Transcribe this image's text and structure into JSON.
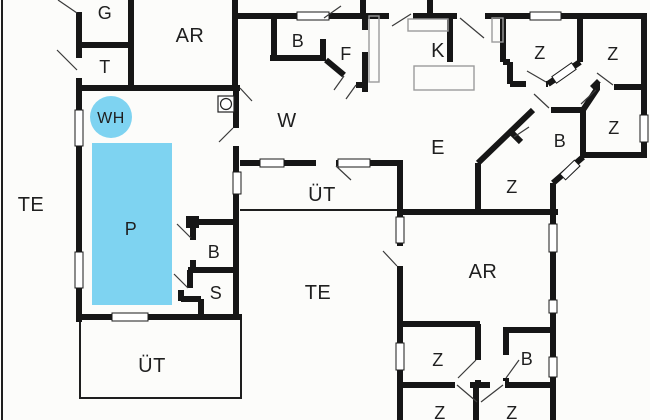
{
  "colors": {
    "pool_blue": "#7ed3f1",
    "wall": "#161616",
    "furniture_gray": "#9b9b9b",
    "background": "#fcfcfa",
    "label": "#1f1f1f"
  },
  "rooms": [
    {
      "id": "g",
      "label": "G"
    },
    {
      "id": "t",
      "label": "T"
    },
    {
      "id": "ar-top",
      "label": "AR"
    },
    {
      "id": "b-top",
      "label": "B"
    },
    {
      "id": "f",
      "label": "F"
    },
    {
      "id": "k",
      "label": "K"
    },
    {
      "id": "z-top-1",
      "label": "Z"
    },
    {
      "id": "z-top-2",
      "label": "Z"
    },
    {
      "id": "wh",
      "label": "WH"
    },
    {
      "id": "w",
      "label": "W"
    },
    {
      "id": "e",
      "label": "E"
    },
    {
      "id": "b-mid",
      "label": "B"
    },
    {
      "id": "z-right",
      "label": "Z"
    },
    {
      "id": "z-mid",
      "label": "Z"
    },
    {
      "id": "te-left",
      "label": "TE"
    },
    {
      "id": "p",
      "label": "P"
    },
    {
      "id": "uet-top",
      "label": "ÜT"
    },
    {
      "id": "b-pool",
      "label": "B"
    },
    {
      "id": "s",
      "label": "S"
    },
    {
      "id": "te-mid",
      "label": "TE"
    },
    {
      "id": "uet-bottom",
      "label": "ÜT"
    },
    {
      "id": "ar-se",
      "label": "AR"
    },
    {
      "id": "z-se",
      "label": "Z"
    },
    {
      "id": "b-se",
      "label": "B"
    },
    {
      "id": "z-bottom-1",
      "label": "Z"
    },
    {
      "id": "z-bottom-2",
      "label": "Z"
    }
  ]
}
